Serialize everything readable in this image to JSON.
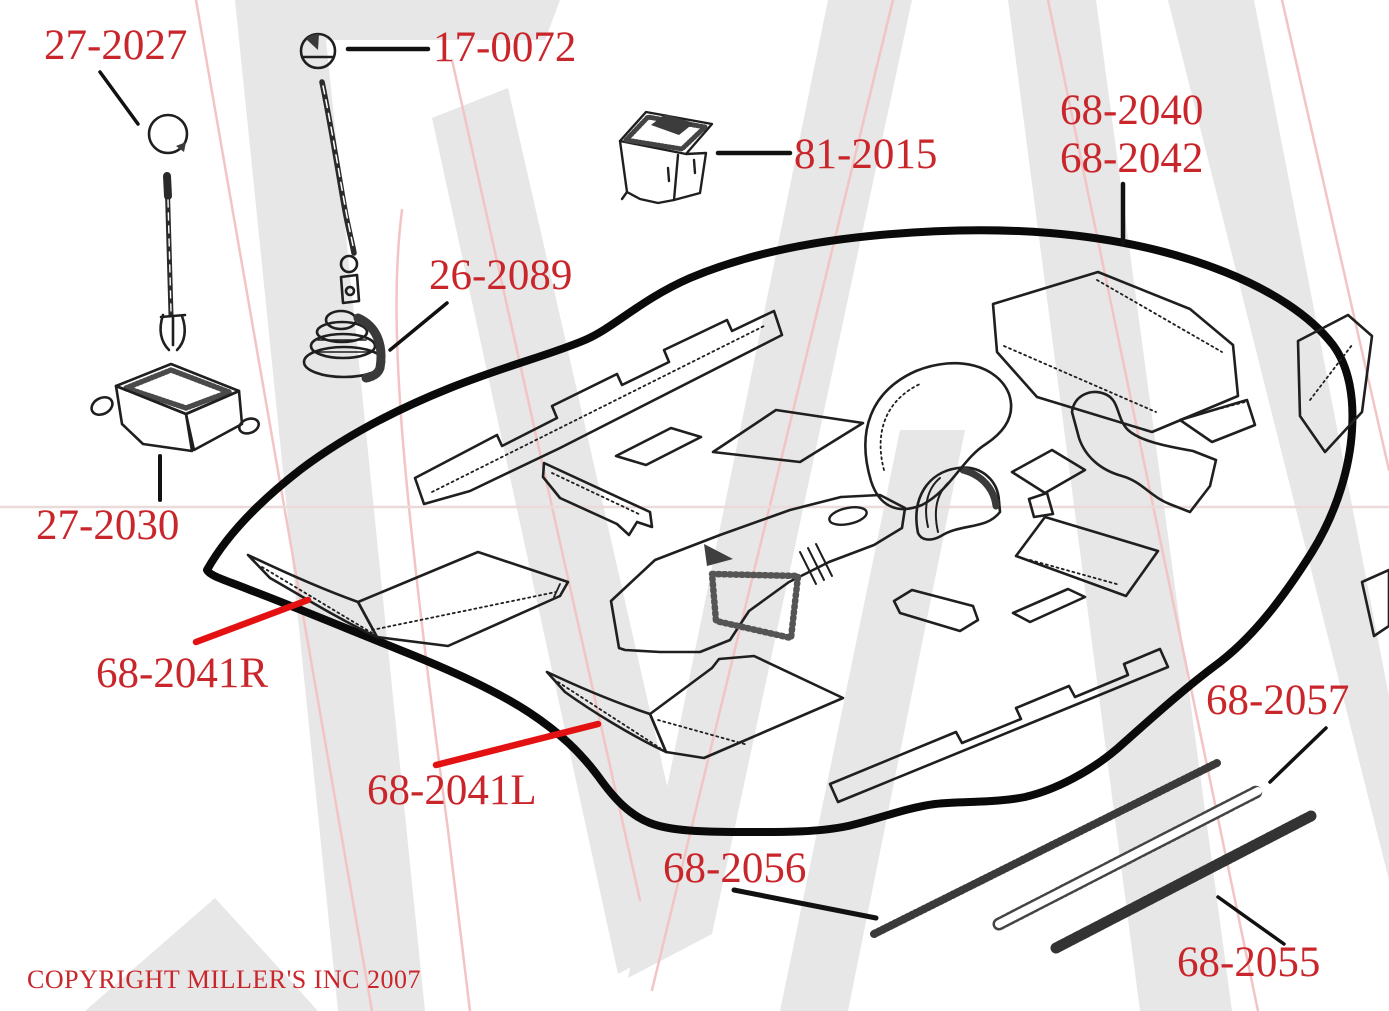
{
  "colors": {
    "label_red": "#c9262c",
    "leader_red": "#e31111",
    "ink_black": "#1f1f1f",
    "outline_black": "#0a0a0a",
    "watermark_gray": "#e7e7e7",
    "watermark_pink": "#f3c4c4"
  },
  "labels": {
    "p27_2027": "27-2027",
    "p17_0072": "17-0072",
    "p81_2015": "81-2015",
    "p68_2040": "68-2040",
    "p68_2042": "68-2042",
    "p26_2089": "26-2089",
    "p27_2030": "27-2030",
    "p68_2041R": "68-2041R",
    "p68_2041L": "68-2041L",
    "p68_2056": "68-2056",
    "p68_2057": "68-2057",
    "p68_2055": "68-2055"
  },
  "footer": {
    "copyright": "COPYRIGHT MILLER'S INC 2007"
  }
}
